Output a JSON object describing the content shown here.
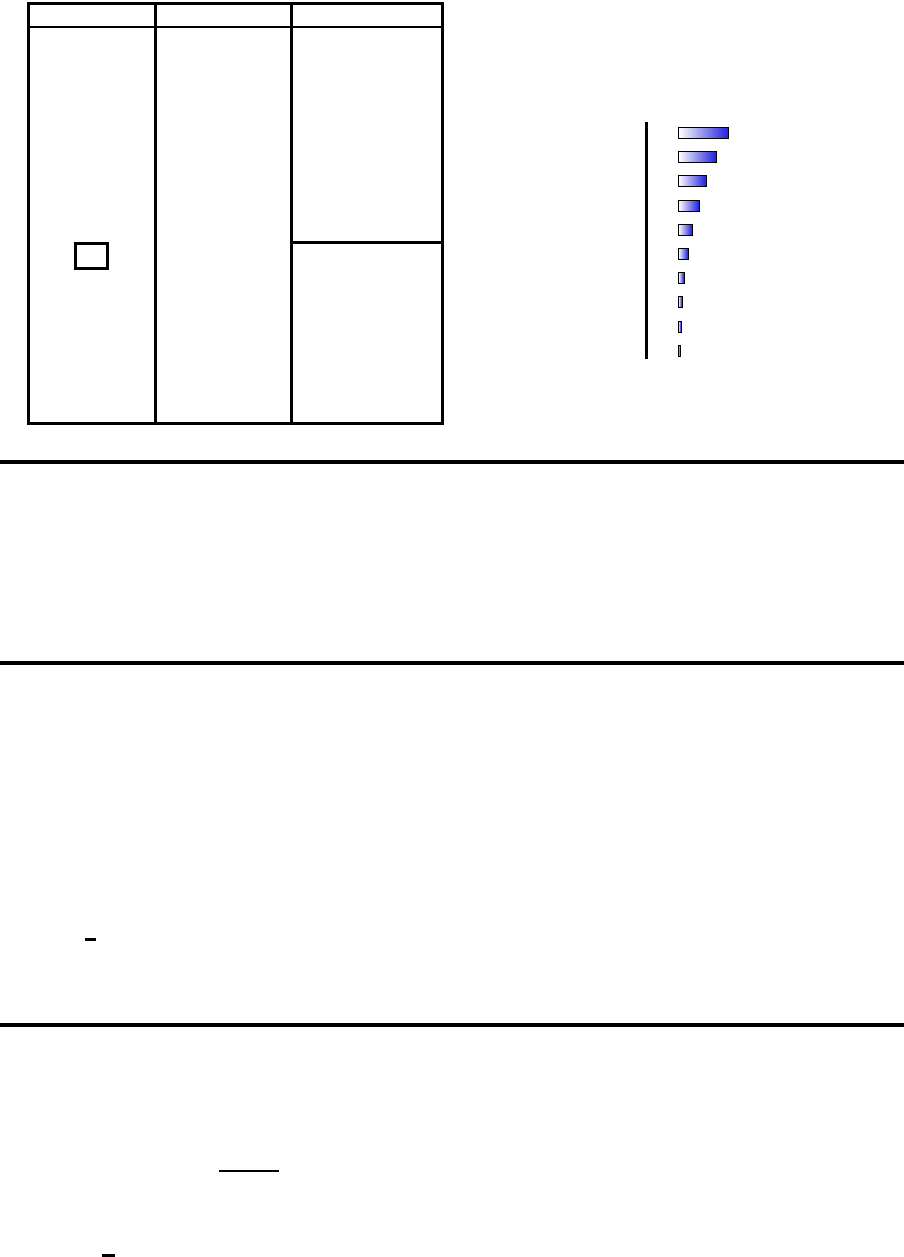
{
  "page": {
    "background_color": "#ffffff",
    "rule_color": "#000000",
    "visible_text": ""
  },
  "table": {
    "columns": 3,
    "header_labels": [
      "",
      "",
      ""
    ],
    "checkbox_checked": false
  },
  "chart_data": {
    "type": "bar",
    "orientation": "horizontal",
    "title": "",
    "xlabel": "",
    "ylabel": "",
    "categories": [
      "",
      "",
      "",
      "",
      "",
      "",
      "",
      "",
      "",
      ""
    ],
    "bar_lengths_px": [
      51,
      39,
      29,
      21.5,
      14.5,
      10.5,
      7,
      5,
      3.5,
      2.5
    ],
    "values_relative": [
      1.0,
      0.76,
      0.57,
      0.42,
      0.28,
      0.21,
      0.14,
      0.1,
      0.07,
      0.05
    ],
    "bar_count": 10,
    "bar_height_px": 12,
    "bar_pitch_px": 24.2,
    "axis": "single vertical line at left, no ticks, no labels",
    "grid": false,
    "legend": false,
    "colors": {
      "bar_gradient_start": "#ffffff",
      "bar_gradient_end": "#2424dd",
      "bar_border": "#000000",
      "axis_line": "#000000"
    }
  }
}
